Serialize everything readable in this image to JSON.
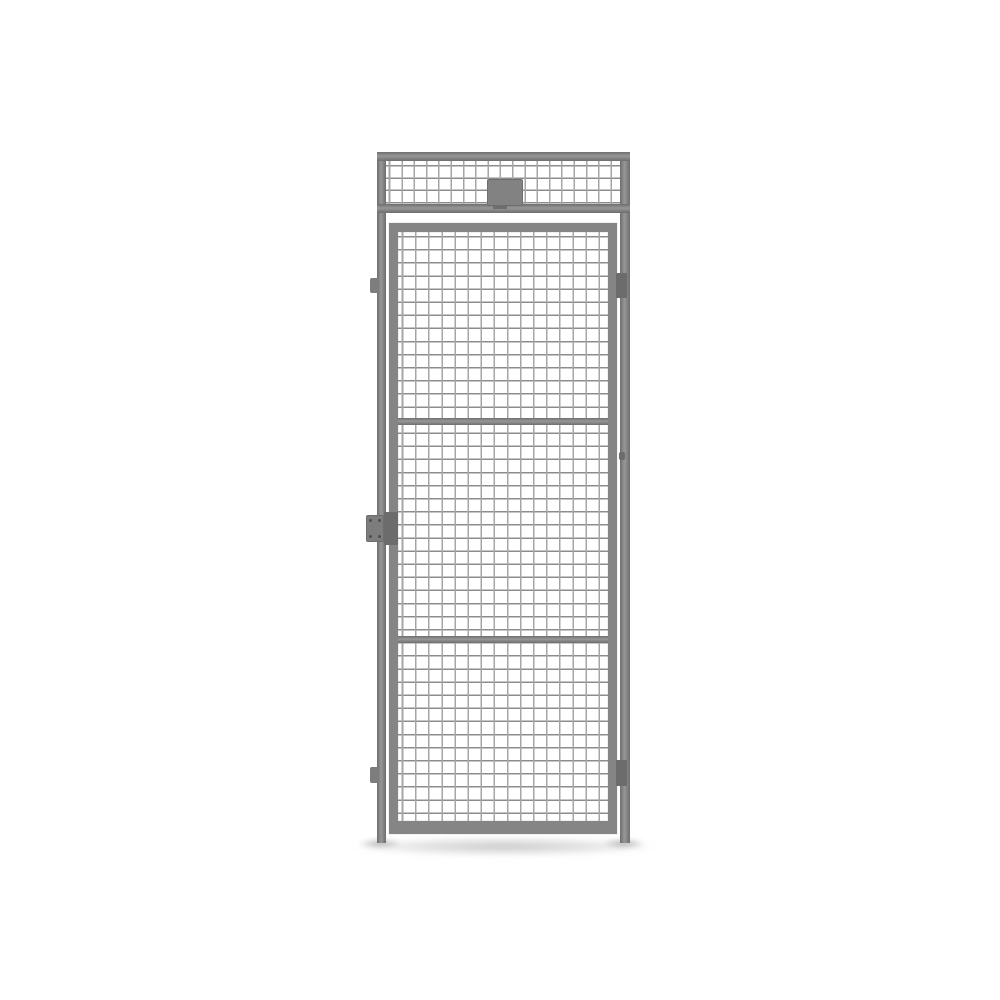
{
  "image": {
    "description": "Studio product render of a grey steel wire-mesh partition panel: full-height frame posts, a mesh transom panel on top with a blank grey label plate, and a hinged wire-mesh door below with two horizontal mid-rails, two hinges on the right side, a lock hasp plate with four screws on the left side, standing on a white background with a soft ground shadow",
    "visible_text": ""
  },
  "colors": {
    "bg": "#ffffff",
    "frame": "#858585",
    "frame_mid": "#979797",
    "frame_edge": "#6e6e6e",
    "mesh_wire_h": "#8c8c8c",
    "mesh_wire_v": "#a6a6a6",
    "hinge": "#6c6c6c",
    "lock_plate": "#7d7d7d",
    "screw": "#4f4f4f",
    "name_plate": "#828282"
  },
  "parts": [
    "frame-post-left",
    "frame-post-right",
    "transom-top-rail",
    "transom-mesh",
    "transom-bottom-rail",
    "label-plate",
    "door-panel",
    "door-mesh",
    "door-mid-rail-upper",
    "door-mid-rail-lower",
    "hinge-top-right",
    "hinge-bottom-right",
    "hinge-pin-middle-right",
    "mounting-lug-top-left",
    "mounting-lug-bottom-left",
    "lock-hasp-plate-left",
    "lock-block-left",
    "ground-shadow"
  ]
}
